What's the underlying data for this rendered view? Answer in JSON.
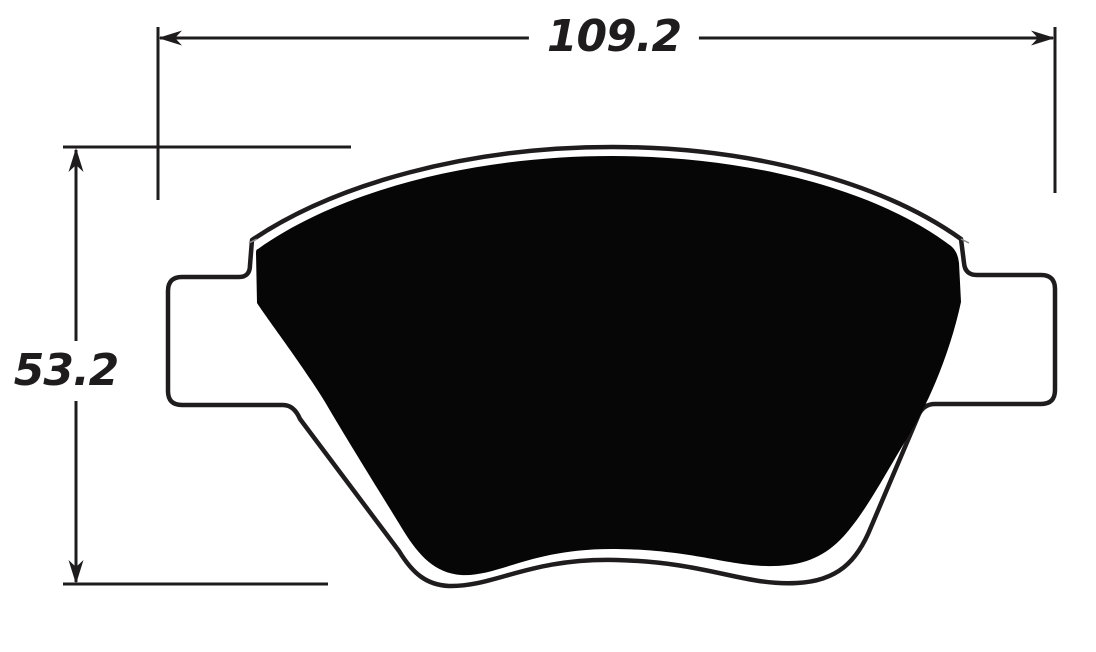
{
  "diagram": {
    "subject": "brake-pad-dimension-drawing",
    "dimensions": {
      "width_label": "109.2",
      "height_label": "53.2"
    },
    "colors": {
      "ink": "#1e1c1c",
      "pad_fill": "#060606",
      "background": "#ffffff"
    }
  }
}
